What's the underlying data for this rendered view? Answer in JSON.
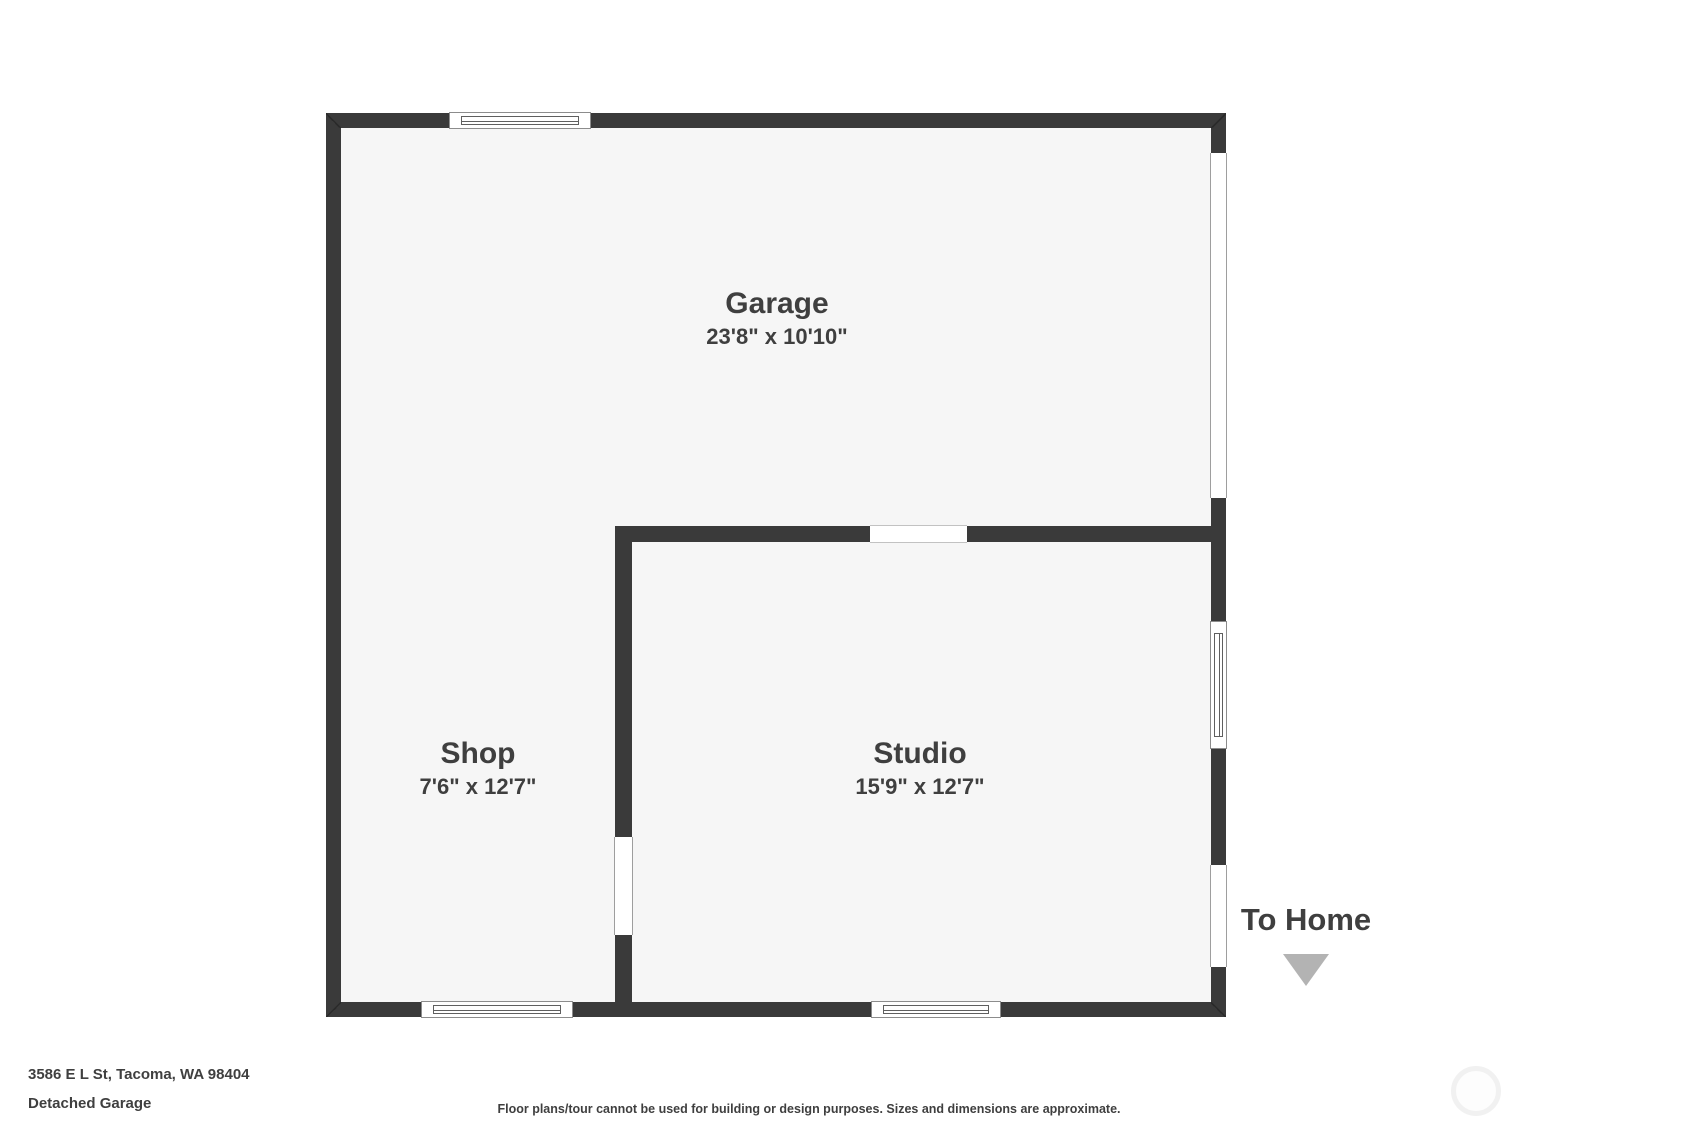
{
  "plan": {
    "rooms": [
      {
        "name": "Garage",
        "dimensions": "23'8\" x 10'10\""
      },
      {
        "name": "Shop",
        "dimensions": "7'6\" x 12'7\""
      },
      {
        "name": "Studio",
        "dimensions": "15'9\" x 12'7\""
      }
    ],
    "exit": {
      "label": "To Home",
      "arrow_icon": "triangle-down"
    }
  },
  "footer": {
    "address": "3586 E L St, Tacoma, WA 98404",
    "plan_title": "Detached Garage",
    "disclaimer": "Floor plans/tour cannot be used for building or design purposes. Sizes and dimensions are approximate."
  },
  "colors": {
    "wall": "#3a3a3a",
    "floor": "#f6f6f6",
    "text": "#3f3f3f",
    "arrow": "#b3b3b3",
    "background": "#ffffff"
  }
}
